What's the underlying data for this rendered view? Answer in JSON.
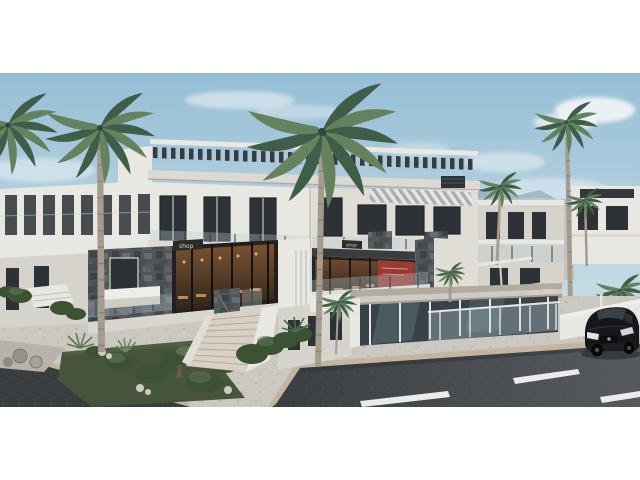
{
  "meta": {
    "type": "architectural-3d-render-photograph",
    "description": "Exterior rendering of a modern white two-storey apartment and commercial complex on a street corner: rooftop slatted pergola, glass balconies, dark stone accent walls, warm-lit corner restaurant with small shop signs, wide travertine staircase, landscaped planter island with bushes and palms, tall palm trees, distant white villas and hazy mountains, asphalt road with dashed lane markings and a black hatchback car, letterboxed with white bands top and bottom."
  },
  "signs": {
    "shop_left": "shop",
    "shop_right": "shop"
  },
  "palette": {
    "letterbox": "#ffffff",
    "sky_top": "#95bed5",
    "sky_mid": "#bdd7e2",
    "sky_bottom": "#d9e7ec",
    "cloud": "#f2f6f8",
    "mountain": "#97abb6",
    "wall_bright": "#e9e7e1",
    "wall_light": "#e0ddd6",
    "wall_shadow": "#d6d3cc",
    "fascia": "#dcd9d2",
    "pergola_slat": "#383c3f",
    "glass_dark": "#2d3236",
    "frame_dark": "#23272a",
    "balustrade_glass": "#b9cdd6",
    "stone_base": "#515659",
    "stone_dark": "#3e4245",
    "stone_light": "#666c70",
    "warm_interior": "#7a5132",
    "warm_glow": "#e8b06a",
    "table_wood": "#b5835a",
    "menu_red": "#9b3a30",
    "sign_dark": "#2b2b28",
    "awning_stripe": "#a8aeb2",
    "pavement": "#cbc8c1",
    "terrace": "#d9d6cf",
    "curb_tan": "#c3b5a0",
    "road_dark": "#3a3d40",
    "road_light": "#565a5e",
    "marking_white": "#eaeceb",
    "grass": "#46543c",
    "bush_dark": "#3b5233",
    "bush_light": "#5d7150",
    "frond_dark": "#3f5d49",
    "frond_light": "#64825e",
    "palm_trunk": "#a59c90",
    "palm_ring": "#857b6f",
    "rock_grey": "#979289",
    "pebble_white": "#cfcabf",
    "pavilion_roof": "#b2aba0",
    "car_black": "#15171a",
    "car_window": "#3a4045",
    "headlight": "#dfe3e5"
  },
  "scene": {
    "objects": [
      {
        "name": "main-building",
        "label": "white modern apartment block with rooftop pergola"
      },
      {
        "name": "corner-restaurant",
        "label": "glass-front restaurant with warm lighting and shop signs"
      },
      {
        "name": "stone-accent-walls",
        "label": "dark natural stone cladding"
      },
      {
        "name": "staircase",
        "label": "wide travertine entrance stairs"
      },
      {
        "name": "planter-island",
        "label": "landscaped island with bushes, bonsai, rocks"
      },
      {
        "name": "palm-trees",
        "label": "tall coconut palms"
      },
      {
        "name": "distant-villas",
        "label": "white villas and hazy mountains"
      },
      {
        "name": "street",
        "label": "asphalt road with dashed lane markings"
      },
      {
        "name": "car",
        "label": "black hatchback car"
      }
    ]
  }
}
